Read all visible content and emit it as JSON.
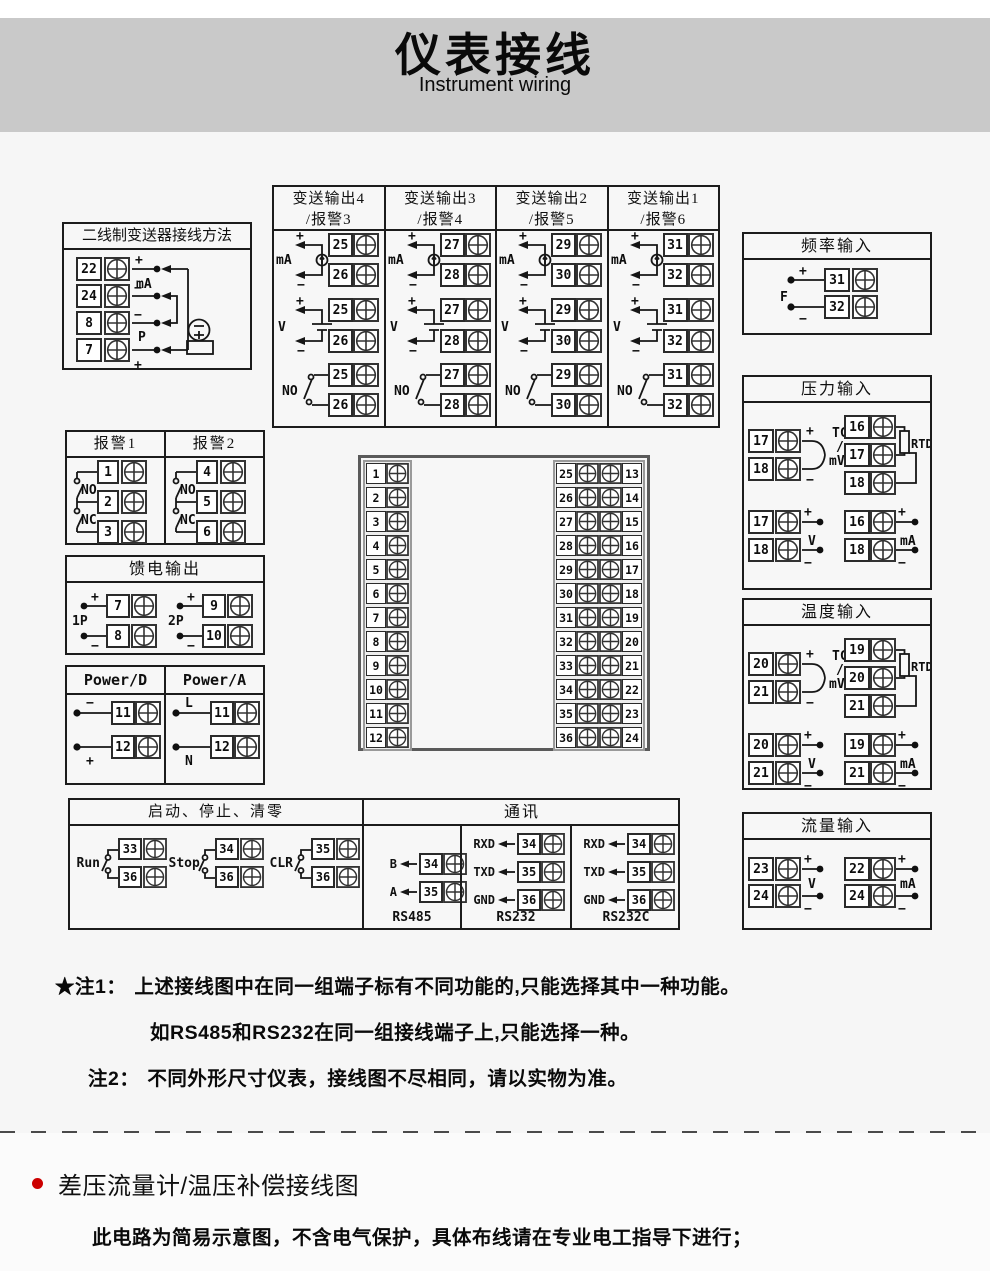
{
  "header": {
    "title": "仪表接线",
    "subtitle": "Instrument wiring"
  },
  "colors": {
    "banner_bg": "#c9c9c9",
    "bullet": "#cc0000",
    "wire": "#161616"
  },
  "labels": {
    "plus": "+",
    "minus": "−",
    "ma": "mA",
    "v": "V",
    "no": "NO",
    "nc": "NC",
    "f": "F",
    "p": "P",
    "tc": "TC",
    "slash": "/",
    "mv": "mV",
    "rtd": "RTD"
  },
  "two_wire": {
    "title": "二线制变送器接线方法",
    "terminals": [
      "22",
      "24",
      "8",
      "7"
    ]
  },
  "transmit": {
    "columns": [
      {
        "line1": "变送输出4",
        "line2": "/报警3",
        "a": "25",
        "b": "26"
      },
      {
        "line1": "变送输出3",
        "line2": "/报警4",
        "a": "27",
        "b": "28"
      },
      {
        "line1": "变送输出2",
        "line2": "/报警5",
        "a": "29",
        "b": "30"
      },
      {
        "line1": "变送输出1",
        "line2": "/报警6",
        "a": "31",
        "b": "32"
      }
    ]
  },
  "freq": {
    "title": "频率输入",
    "a": "31",
    "b": "32"
  },
  "alarm": {
    "columns": [
      {
        "title": "报警1",
        "n1": "1",
        "n2": "2",
        "n3": "3"
      },
      {
        "title": "报警2",
        "n1": "4",
        "n2": "5",
        "n3": "6"
      }
    ]
  },
  "feed": {
    "title": "馈电输出",
    "pairs": [
      {
        "label": "1P",
        "a": "7",
        "b": "8"
      },
      {
        "label": "2P",
        "a": "9",
        "b": "10"
      }
    ]
  },
  "power": {
    "columns": [
      {
        "title": "Power/D",
        "top": "−",
        "bottom": "+",
        "a": "11",
        "b": "12"
      },
      {
        "title": "Power/A",
        "top": "L",
        "bottom": "N",
        "a": "11",
        "b": "12"
      }
    ]
  },
  "center": {
    "left": [
      "1",
      "2",
      "3",
      "4",
      "5",
      "6",
      "7",
      "8",
      "9",
      "10",
      "11",
      "12"
    ],
    "right": [
      {
        "l": "25",
        "r": "13"
      },
      {
        "l": "26",
        "r": "14"
      },
      {
        "l": "27",
        "r": "15"
      },
      {
        "l": "28",
        "r": "16"
      },
      {
        "l": "29",
        "r": "17"
      },
      {
        "l": "30",
        "r": "18"
      },
      {
        "l": "31",
        "r": "19"
      },
      {
        "l": "32",
        "r": "20"
      },
      {
        "l": "33",
        "r": "21"
      },
      {
        "l": "34",
        "r": "22"
      },
      {
        "l": "35",
        "r": "23"
      },
      {
        "l": "36",
        "r": "24"
      }
    ]
  },
  "sensors": [
    {
      "title": "压力输入",
      "tc_a": "17",
      "tc_b": "18",
      "rtd1": "16",
      "rtd2": "17",
      "rtd3": "18",
      "v_a": "17",
      "v_b": "18",
      "ma_a": "16",
      "ma_b": "18"
    },
    {
      "title": "温度输入",
      "tc_a": "20",
      "tc_b": "21",
      "rtd1": "19",
      "rtd2": "20",
      "rtd3": "21",
      "v_a": "20",
      "v_b": "21",
      "ma_a": "19",
      "ma_b": "21"
    }
  ],
  "flow": {
    "title": "流量输入",
    "v_a": "23",
    "v_b": "24",
    "ma_a": "22",
    "ma_b": "24"
  },
  "bottom_box": {
    "left_title": "启动、停止、清零",
    "groups": [
      {
        "label": "Run",
        "a": "33",
        "b": "36"
      },
      {
        "label": "Stop",
        "a": "34",
        "b": "36"
      },
      {
        "label": "CLR",
        "a": "35",
        "b": "36"
      }
    ],
    "comm_title": "通讯",
    "rs485": {
      "rows": [
        {
          "sig": "B",
          "num": "34"
        },
        {
          "sig": "A",
          "num": "35"
        }
      ],
      "caption": "RS485"
    },
    "rs232": {
      "rows": [
        {
          "sig": "RXD",
          "num": "34"
        },
        {
          "sig": "TXD",
          "num": "35"
        },
        {
          "sig": "GND",
          "num": "36"
        }
      ],
      "caption": "RS232"
    },
    "rs232c": {
      "rows": [
        {
          "sig": "RXD",
          "num": "34"
        },
        {
          "sig": "TXD",
          "num": "35"
        },
        {
          "sig": "GND",
          "num": "36"
        }
      ],
      "caption": "RS232C"
    }
  },
  "notes": {
    "note1_tag": "★注1：",
    "note1_line1": "上述接线图中在同一组端子标有不同功能的,只能选择其中一种功能。",
    "note1_line2": "如RS485和RS232在同一组接线端子上,只能选择一种。",
    "note2_tag": "注2：",
    "note2_text": "不同外形尺寸仪表，接线图不尽相同，请以实物为准。"
  },
  "footer": {
    "heading": "差压流量计/温压补偿接线图",
    "subtext": "此电路为简易示意图，不含电气保护，具体布线请在专业电工指导下进行；"
  }
}
